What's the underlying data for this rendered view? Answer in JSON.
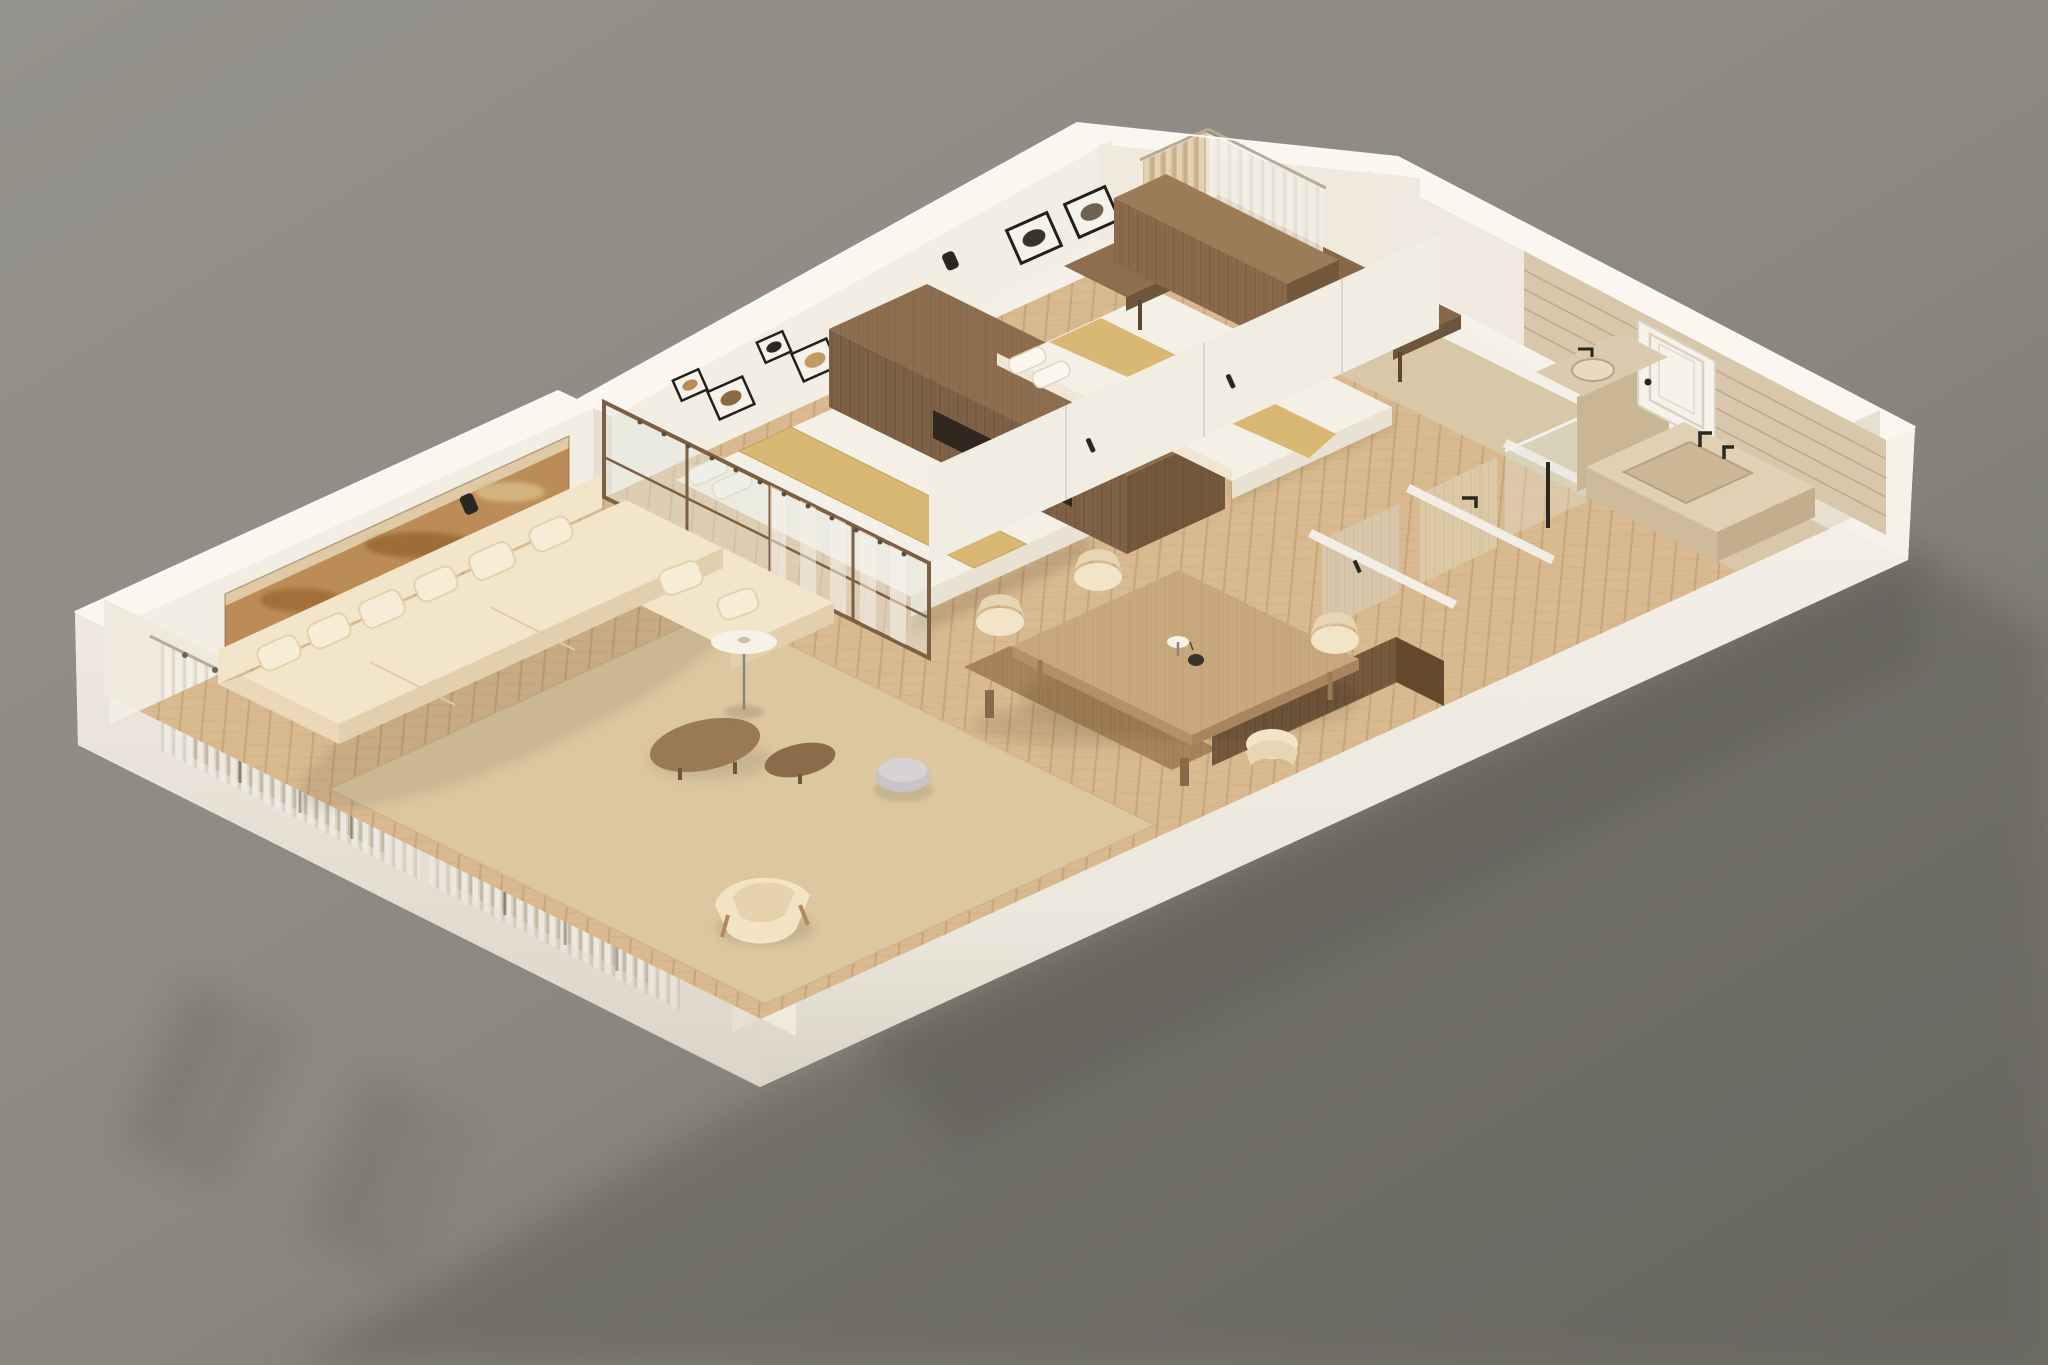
{
  "meta": {
    "title": "3D isometric cutaway render of a long apartment floor plan",
    "style": "photorealistic architectural dollhouse view, no text labels",
    "background": "plain warm-gray studio backdrop with soft ground reflection"
  },
  "colors": {
    "bg_top": "#94928c",
    "bg_mid": "#8b897f",
    "bg_bottom": "#706f67",
    "ground_shadow": "#63625b",
    "wall_top": "#faf7f1",
    "wall_white": "#f4f0e9",
    "wall_outer_sw": "#ece6dc",
    "wall_outer_se": "#f1ece3",
    "wall_inner": "#f3eee4",
    "wall_inner_shadow": "#e6dfd2",
    "floor_wood": "#d9ba90",
    "rug": "#dcc7a0",
    "sofa": "#f3e5c9",
    "sofa_shadow": "#e2cfae",
    "pillow": "#f7ecd6",
    "walnut": "#8d6e4f",
    "walnut_dark": "#74583c",
    "oak": "#c9a87d",
    "linen": "#f5f0e5",
    "gold_throw": "#d8b873",
    "travertine": "#d8c7ab",
    "travertine_dark": "#c8b695",
    "curtain_tan": "#d6bd94",
    "curtain_sheer": "#f0ebe2",
    "glass": "#dfe4dd",
    "frame_black": "#23201c",
    "accent_black": "#2a2723",
    "artwork_rust": "#bb8c57",
    "artwork_rust_dark": "#9a6630",
    "pouf": "#c9c4c8",
    "lamp_shade": "#f7f2e7"
  },
  "scene": {
    "rooms": [
      {
        "name": "Living Room",
        "items": [
          "L-shaped cream sectional sofa",
          "six scatter cushions",
          "two kidney-shaped walnut coffee tables",
          "lavender-gray pouf",
          "floor lamp with disc shade",
          "cream lounge armchair",
          "beige area rug",
          "long rust abstract artwork niche",
          "two curtained window openings"
        ]
      },
      {
        "name": "Dining Area",
        "items": [
          "light oak plank dining table",
          "four cream tub chairs",
          "table lamp and dark vase",
          "walnut media console",
          "walnut bench at partition"
        ]
      },
      {
        "name": "Bedroom 1",
        "items": [
          "double bed with white linen",
          "gold throw runner",
          "four framed prints",
          "glass and walnut partition with sheer curtain",
          "walnut wardrobe volume with niche"
        ]
      },
      {
        "name": "Bedroom 2",
        "items": [
          "double bed with white linen",
          "gold throw runner",
          "two black framed prints",
          "walnut corner desk and chair",
          "tan and sheer curtains",
          "low walnut wardrobe"
        ]
      },
      {
        "name": "Corridor",
        "items": [
          "built-in white closet wall with black handles",
          "two open travertine storage bays"
        ]
      },
      {
        "name": "Bathroom",
        "items": [
          "white paneled door",
          "travertine vanity with inset basin",
          "round vessel sink",
          "black wall faucets",
          "glass shower screen with black column",
          "paper holder"
        ]
      }
    ],
    "counts": {
      "window_openings": 2,
      "doors": 1,
      "beds": 2,
      "framed_artworks": 7,
      "sofa_seats": 5
    }
  }
}
